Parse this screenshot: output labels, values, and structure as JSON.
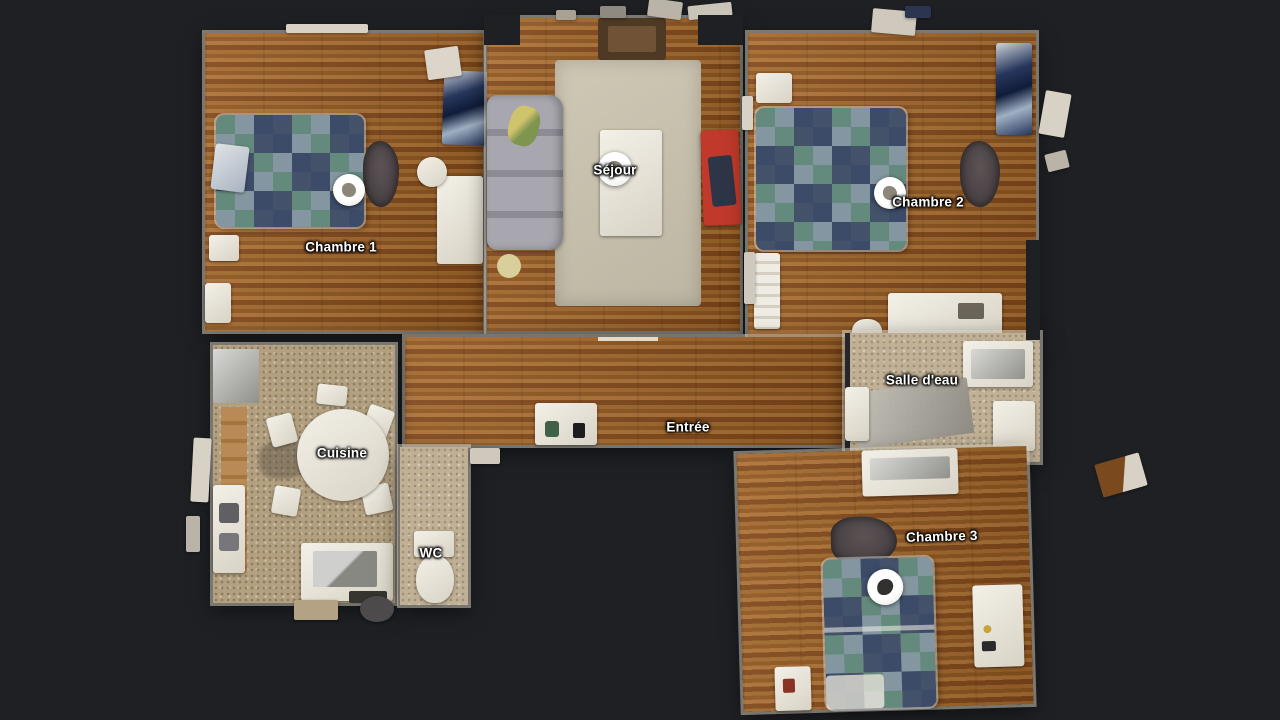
{
  "app": {
    "view_name": "apartment-dollhouse-floorplan",
    "background_color": "#1e2024"
  },
  "rooms": [
    {
      "id": "chambre-1",
      "label": "Chambre 1",
      "floor": "wood",
      "has_nav_puck": true
    },
    {
      "id": "sejour",
      "label": "Séjour",
      "floor": "wood",
      "has_nav_puck": true
    },
    {
      "id": "chambre-2",
      "label": "Chambre 2",
      "floor": "wood",
      "has_nav_puck": true
    },
    {
      "id": "entree",
      "label": "Entrée",
      "floor": "wood",
      "has_nav_puck": false
    },
    {
      "id": "salle-deau",
      "label": "Salle d'eau",
      "floor": "beige-tile",
      "has_nav_puck": false
    },
    {
      "id": "cuisine",
      "label": "Cuisine",
      "floor": "speckled-tile",
      "has_nav_puck": false
    },
    {
      "id": "wc",
      "label": "WC",
      "floor": "beige-tile",
      "has_nav_puck": false
    },
    {
      "id": "chambre-3",
      "label": "Chambre 3",
      "floor": "wood",
      "has_nav_puck": true
    }
  ],
  "navigation_pucks": [
    {
      "room": "Chambre 1"
    },
    {
      "room": "Séjour"
    },
    {
      "room": "Chambre 2"
    },
    {
      "room": "Chambre 3"
    }
  ],
  "colors": {
    "background": "#1e2024",
    "wood_floor": "#9a5f28",
    "sejour_rug": "#c8c1ae",
    "kitchen_tile": "#b2a080",
    "bathroom_tile": "#c0b196",
    "quilt_cream": "#ded5bd",
    "quilt_teal": "#4e7d72",
    "quilt_navy": "#2e3f5e",
    "quilt_gray_blue": "#8b99a8",
    "sofa_gray": "#9b9aa2",
    "red_bench": "#c0392a",
    "dark_rug": "#463e40",
    "label_text": "#ffffff"
  }
}
